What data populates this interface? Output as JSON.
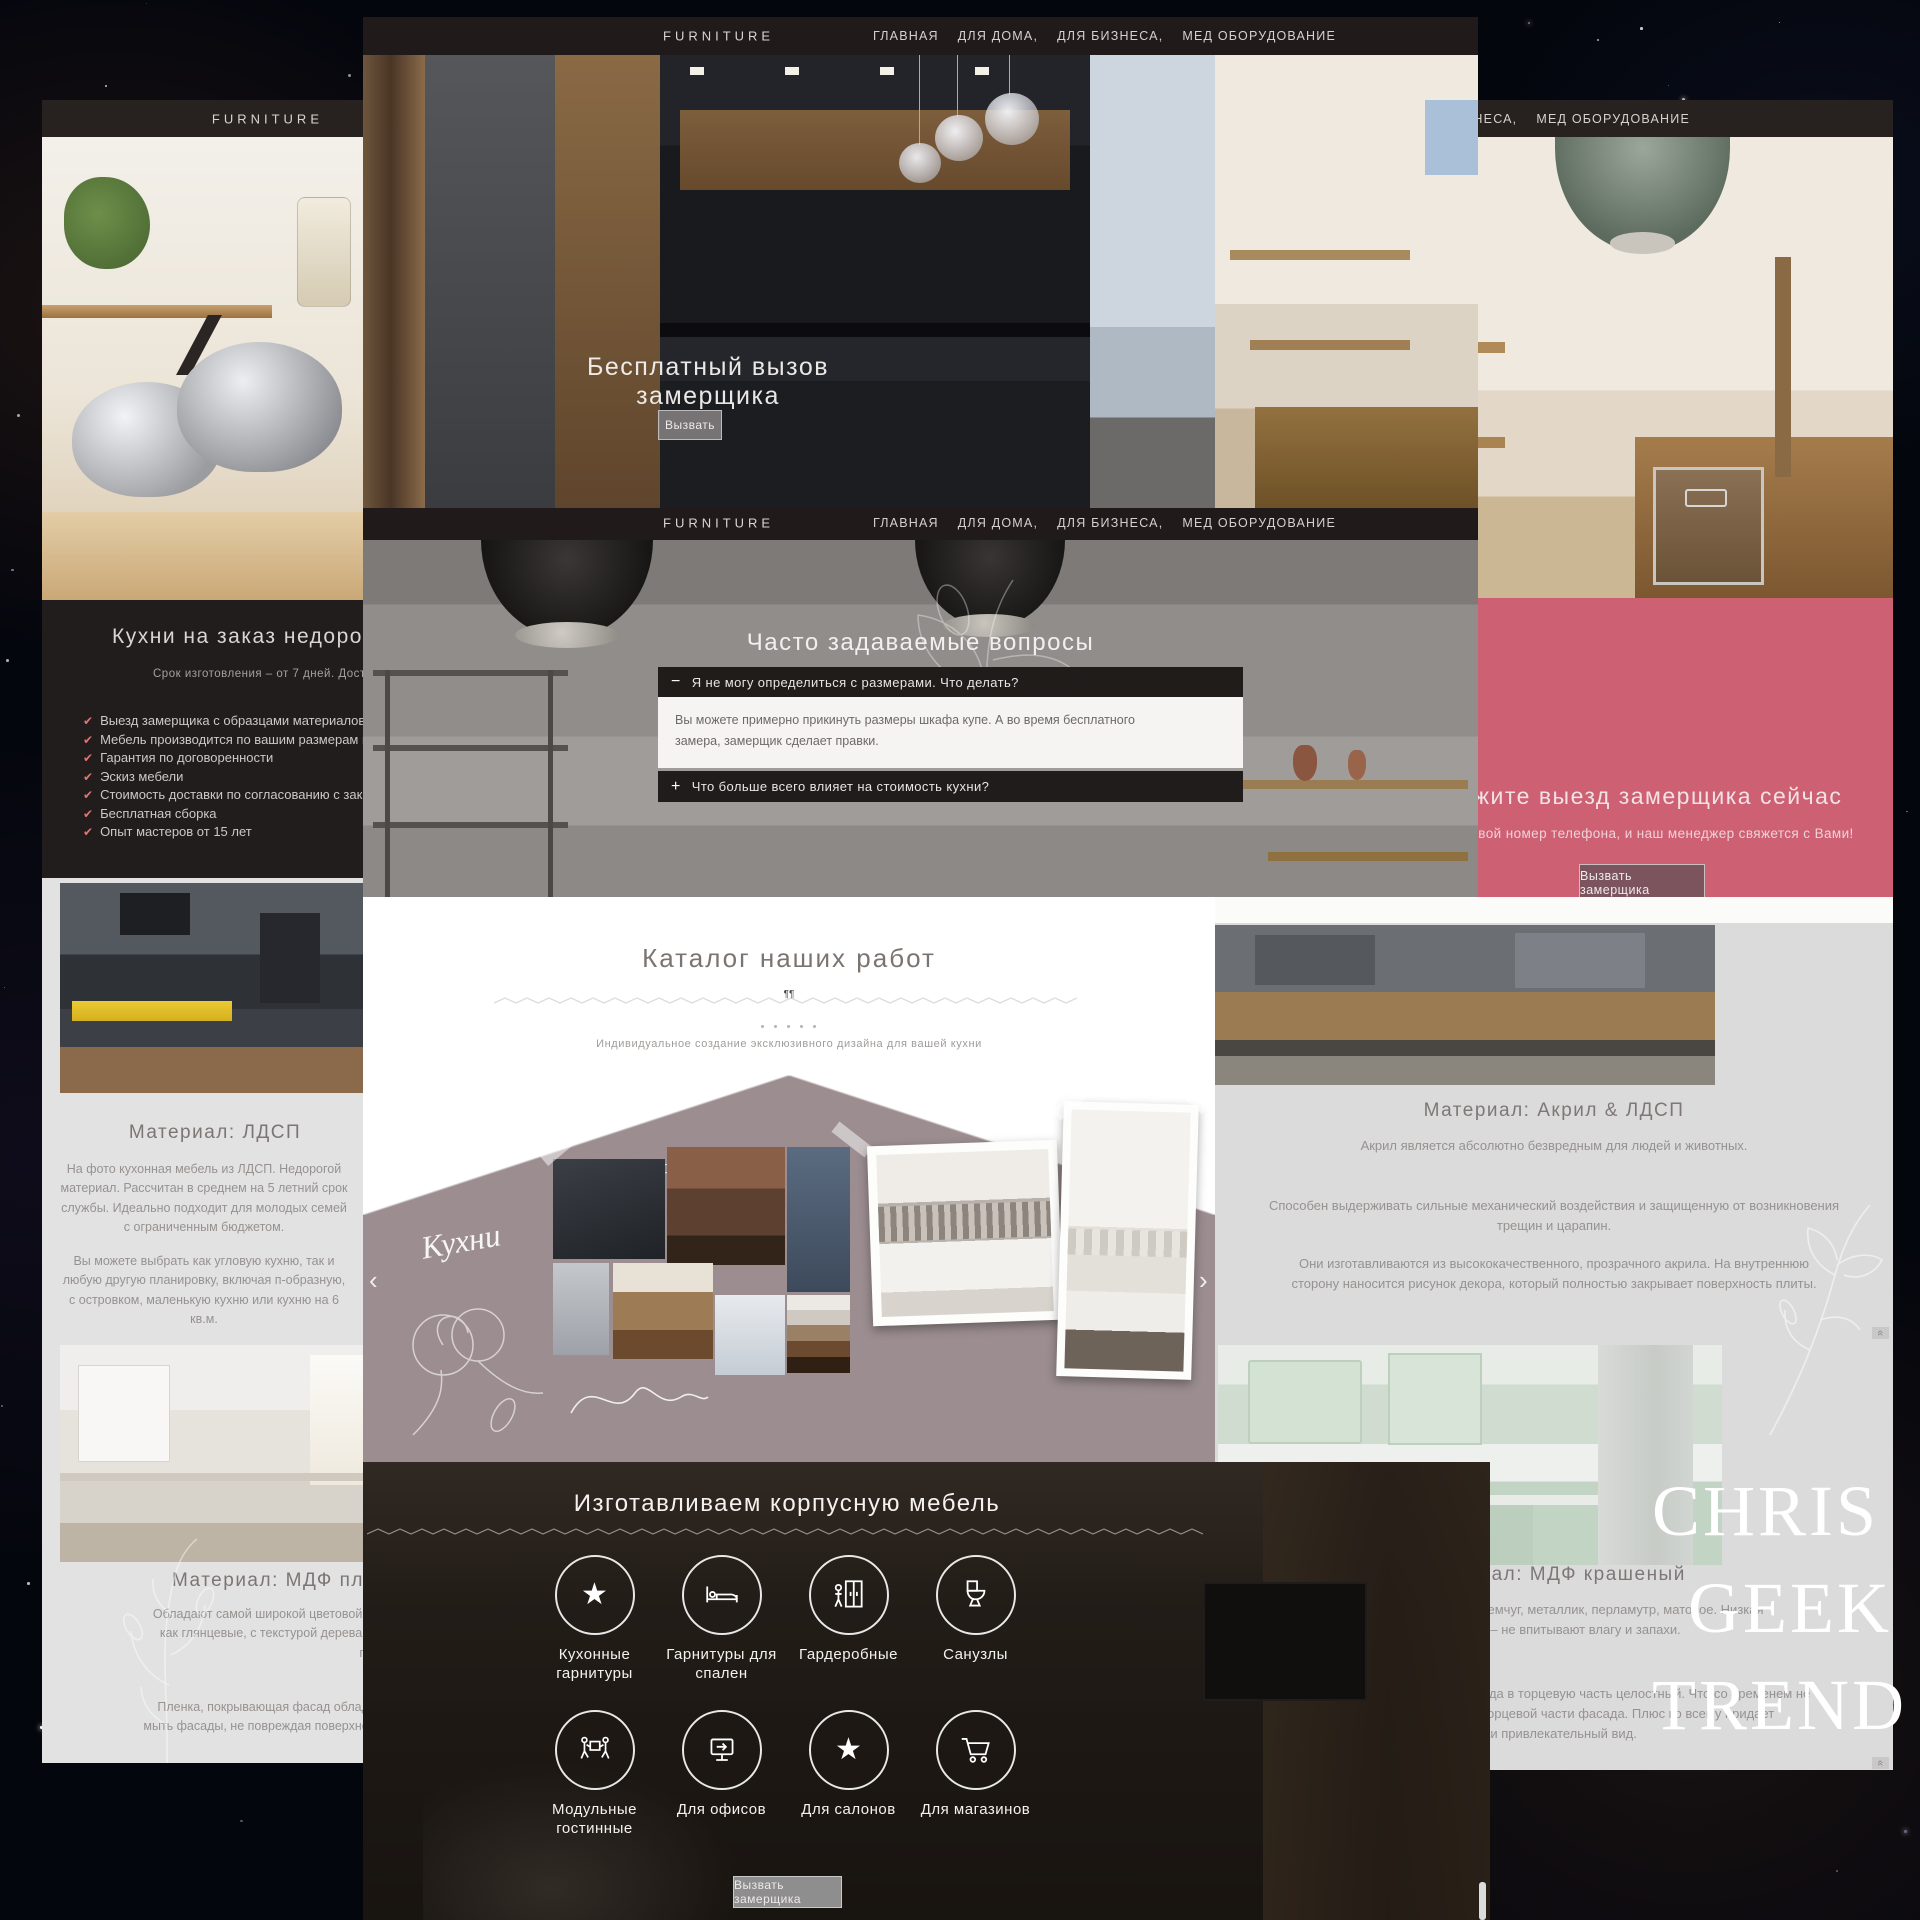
{
  "site": {
    "logo": "FURNITURE",
    "menu": [
      "ГЛАВНАЯ",
      "ДЛЯ ДОМА,",
      "ДЛЯ БИЗНЕСА,",
      "МЕД ОБОРУДОВАНИЕ"
    ]
  },
  "hero": {
    "title": "Бесплатный вызов замерщика",
    "cta": "Вызвать"
  },
  "faq": {
    "heading": "Часто задаваемые вопросы",
    "items": [
      {
        "icon": "−",
        "question": "Я не могу определиться с размерами. Что делать?",
        "answer": "Вы можете примерно прикинуть размеры шкафа купе. А во время бесплатного замера, замерщик сделает правки."
      },
      {
        "icon": "+",
        "question": "Что больше всего влияет на стоимость кухни?"
      }
    ]
  },
  "left": {
    "heading": "Кухни на заказ недорого в Алматы",
    "subtitle": "Срок изготовления – от 7 дней. Доставка, сборка!",
    "check_glyph": "✔",
    "checklist": [
      "Выезд замерщика с образцами материалов",
      "Мебель производится по вашим размерам и пожеланиям",
      "Гарантия по договоренности",
      "Эскиз мебели",
      "Стоимость доставки по согласованию с заказчиком",
      "Бесплатная сборка",
      "Опыт мастеров от 15 лет"
    ],
    "ldsp_heading": "Материал: ЛДСП",
    "ldsp_p1": "На фото кухонная мебель из ЛДСП. Недорогой материал. Рассчитан в среднем на 5 летний срок службы. Идеально подходит для молодых семей с ограниченным бюджетом.",
    "ldsp_p2": "Вы можете выбрать как угловую кухню, так и любую другую планировку, включая п-образную, с островком, маленькую кухню или кухню на 6 кв.м.",
    "mdf_heading": "Материал: МДФ плёнка",
    "mdf_p1": "Обладают самой широкой цветовой гаммой из существующих на рынке. Существует как глянцевые, с текстурой дерева и однотонные, с фантазийными рисунками или перламутром.",
    "mdf_p2": "Пленка, покрывающая фасад обладает высокой прочностью. При уборке можно мыть фасады, не повреждая поверхность, особенно это касается глянцевых текстур."
  },
  "catalog": {
    "heading": "Каталог наших работ",
    "ornament": "¶¶",
    "subtitle": "Индивидуальное создание эксклюзивного дизайна для вашей кухни",
    "script_main": "Кухни",
    "script_small": "лаковая мебель",
    "prev": "‹",
    "next": "›"
  },
  "workshop": {
    "heading": "Изготавливаем корпусную мебель",
    "items": [
      "Кухонные гарнитуры",
      "Гарнитуры для спален",
      "Гардеробные",
      "Санузлы",
      "Модульные гостинные",
      "Для офисов",
      "Для салонов",
      "Для магазинов"
    ],
    "cta": "Вызвать замерщика"
  },
  "right": {
    "cta_heading": "Закажите выезд замерщика сейчас",
    "cta_subtitle": "Оставьте свой номер телефона, и наш менеджер свяжется с Вами!",
    "cta_button": "Вызвать замерщика",
    "acryl_heading": "Материал: Акрил & ЛДСП",
    "acryl_p1": "Акрил является абсолютно безвредным для людей и животных.",
    "acryl_p2": "Способен выдерживать сильные механический воздействия и защищенную от возникновения трещин и царапин.",
    "acryl_p3": "Они изготавливаются из высококачественного, прозрачного акрила. На внутреннюю сторону наносится рисунок декора, который полностью закрывает поверхность плиты.",
    "mdf2_heading": "Материал: МДФ крашеный",
    "mdf2_p1": "Все виды покрытий – глянец, жемчуг, металлик, перламутр, матовое. Низкая гигроскопичность – не впитывают влагу и запахи.",
    "mdf2_p2": "Переход от лицевой поверхности фасада в торцевую часть целостный. Что со временем не приведет к разбуханию и порче торцевой части фасада. Плюс ко всему придает эстетически привлекательный вид.",
    "scroll_icon": "«"
  },
  "watermark": [
    "CHRIS",
    "GEEK",
    "TREND"
  ],
  "colors": {
    "pink": "#cd6073",
    "check_red": "#e0756d",
    "nav_dark": "#272120",
    "mauve": "#9b8d90",
    "light_section": "#e3e2e2"
  }
}
